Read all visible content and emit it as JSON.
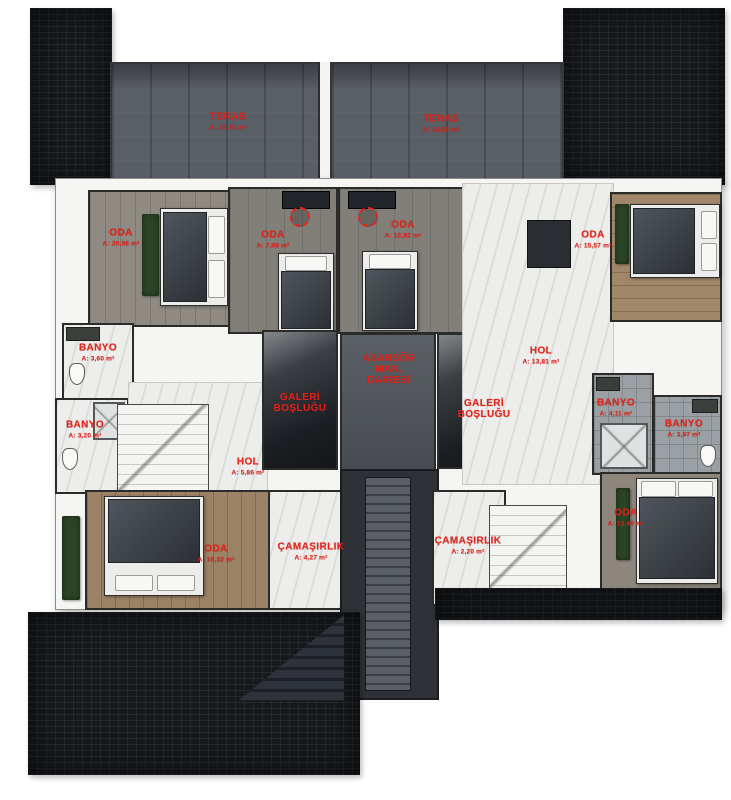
{
  "colors": {
    "label_red": "#e8221a",
    "roof_dark": "#17191d",
    "terrace_gray": "#5a5f66"
  },
  "rooms": {
    "teras_left": {
      "name": "TERAS",
      "area": "A: 14,75 m²"
    },
    "teras_right": {
      "name": "TERAS",
      "area": "A: 14,35 m²"
    },
    "oda_top_left": {
      "name": "ODA",
      "area": "A: 20,06 m²"
    },
    "oda_mid_left": {
      "name": "ODA",
      "area": "A: 7,08 m²"
    },
    "oda_mid_right": {
      "name": "ODA",
      "area": "A: 12,92 m²"
    },
    "oda_top_right": {
      "name": "ODA",
      "area": "A: 15,57 m²"
    },
    "banyo_left_upper": {
      "name": "BANYO",
      "area": "A: 3,60 m²"
    },
    "banyo_left_lower": {
      "name": "BANYO",
      "area": "A: 3,20 m²"
    },
    "asansor_mak_dairesi": {
      "line1": "ASANSÖR",
      "line2": "MAK.",
      "line3": "DAİRESİ"
    },
    "galeri_boslugu_left": {
      "line1": "GALERİ",
      "line2": "BOŞLUĞU"
    },
    "galeri_boslugu_right": {
      "line1": "GALERİ",
      "line2": "BOŞLUĞU"
    },
    "hol_right": {
      "name": "HOL",
      "area": "A: 13,81 m²"
    },
    "hol_left": {
      "name": "HOL",
      "area": "A: 5,86 m²"
    },
    "banyo_right_inner": {
      "name": "BANYO",
      "area": "A: 4,11 m²"
    },
    "banyo_right_outer": {
      "name": "BANYO",
      "area": "A: 3,97 m²"
    },
    "oda_bottom_left": {
      "name": "ODA",
      "area": "A: 16,32 m²"
    },
    "camasirlik_left": {
      "name": "ÇAMAŞIRLIK",
      "area": "A: 4,27 m²"
    },
    "camasirlik_right": {
      "name": "ÇAMAŞIRLIK",
      "area": "A: 2,20 m²"
    },
    "oda_bottom_right": {
      "name": "ODA",
      "area": "A: 13,40 m²"
    }
  }
}
